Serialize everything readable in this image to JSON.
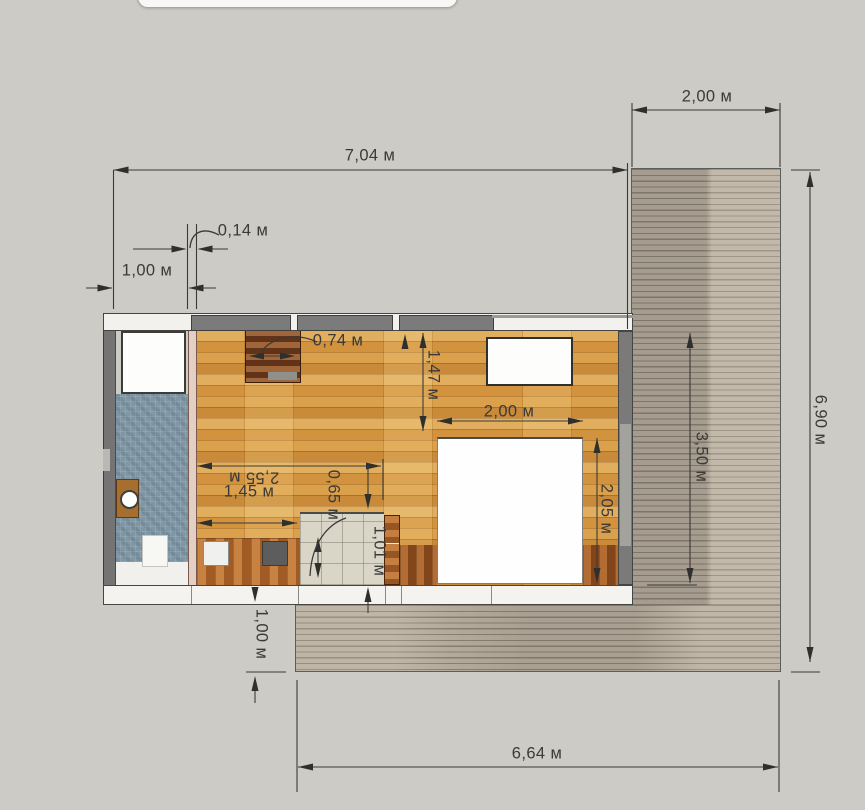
{
  "plan": {
    "unit": "м",
    "dimensions": [
      {
        "id": "total-width",
        "label": "7,04 м",
        "lx": 370,
        "ly": 156,
        "rot": 0,
        "lines": [
          [
            113.5,
            170,
            627.5,
            170
          ],
          [
            113.5,
            170,
            113.5,
            309
          ],
          [
            627.5,
            163,
            627.5,
            329
          ]
        ],
        "arrows": [
          [
            113.5,
            170,
            "left"
          ],
          [
            627.5,
            170,
            "right"
          ]
        ]
      },
      {
        "id": "deck-top-width",
        "label": "2,00 м",
        "lx": 707,
        "ly": 97,
        "rot": 0,
        "lines": [
          [
            632,
            110,
            780,
            110
          ],
          [
            632,
            103,
            632,
            167
          ],
          [
            780,
            103,
            780,
            167
          ]
        ],
        "arrows": [
          [
            632,
            110,
            "left"
          ],
          [
            780,
            110,
            "right"
          ]
        ]
      },
      {
        "id": "side-offset",
        "label": "1,00 м",
        "lx": 147,
        "ly": 271,
        "rot": 0,
        "lines": [
          [
            86,
            288,
            112,
            288
          ],
          [
            189,
            288,
            216,
            288
          ]
        ],
        "arrows": [
          [
            112.5,
            288,
            "right"
          ],
          [
            188.5,
            288,
            "left"
          ]
        ]
      },
      {
        "id": "wall-thickness",
        "label": "0,14 м",
        "lx": 243,
        "ly": 231,
        "rot": 0,
        "lines": [
          [
            133,
            249,
            185,
            249
          ],
          [
            199,
            249,
            228,
            249
          ],
          [
            187.5,
            224,
            187.5,
            309
          ],
          [
            196.5,
            224,
            196.5,
            309
          ]
        ],
        "arrows": [
          [
            186.5,
            249,
            "right"
          ],
          [
            197.5,
            249,
            "left"
          ]
        ],
        "path": "M 219 235 C 202 226 191 233 190 248"
      },
      {
        "id": "wardrobe-width",
        "label": "0,74 м",
        "lx": 338,
        "ly": 341,
        "rot": 0,
        "lines": [
          [
            252,
            356,
            292,
            356
          ]
        ],
        "arrows": [
          [
            249,
            356,
            "left"
          ],
          [
            295,
            356,
            "right"
          ]
        ],
        "path": "M 317 342 C 296 332 272 337 261 352"
      },
      {
        "id": "room-depth",
        "label": "1,47 м",
        "lx": 433,
        "ly": 375,
        "rot": 90,
        "lines": [
          [
            423,
            333,
            423,
            431
          ]
        ],
        "arrows": [
          [
            423,
            333,
            "up"
          ],
          [
            423,
            431,
            "down"
          ]
        ]
      },
      {
        "id": "bed-width",
        "label": "2,00 м",
        "lx": 509,
        "ly": 412,
        "rot": 0,
        "lines": [
          [
            437,
            421,
            583,
            421
          ]
        ],
        "arrows": [
          [
            437,
            421,
            "left"
          ],
          [
            583,
            421,
            "right"
          ]
        ]
      },
      {
        "id": "bed-length",
        "label": "2,05 м",
        "lx": 606,
        "ly": 509,
        "rot": 90,
        "lines": [
          [
            597,
            438,
            597,
            583
          ]
        ],
        "arrows": [
          [
            597,
            438,
            "up"
          ],
          [
            597,
            583,
            "down"
          ]
        ]
      },
      {
        "id": "kitchen-span",
        "label": "2,55 м",
        "lx": 254,
        "ly": 477,
        "rot": 180,
        "lines": [
          [
            197,
            466,
            381,
            466
          ],
          [
            383,
            459,
            383,
            500
          ]
        ],
        "arrows": [
          [
            197,
            466,
            "left"
          ],
          [
            381,
            466,
            "right"
          ]
        ]
      },
      {
        "id": "counter-gap",
        "label": "0,65 м",
        "lx": 333,
        "ly": 495,
        "rot": 90,
        "lines": [
          [
            368,
            466,
            368,
            494
          ]
        ],
        "arrows": [
          [
            368,
            509,
            "down"
          ]
        ]
      },
      {
        "id": "counter-width",
        "label": "1,45 м",
        "lx": 249,
        "ly": 492,
        "rot": 0,
        "lines": [
          [
            197,
            523,
            297,
            523
          ]
        ],
        "arrows": [
          [
            197,
            523,
            "left"
          ],
          [
            297,
            523,
            "right"
          ]
        ]
      },
      {
        "id": "entry-depth",
        "label": "1,01 м",
        "lx": 379,
        "ly": 551,
        "rot": 90,
        "lines": [
          [
            368,
            602,
            368,
            613
          ]
        ],
        "arrows": [
          [
            368,
            587,
            "up"
          ]
        ]
      },
      {
        "id": "deck-span",
        "label": "3,50 м",
        "lx": 701,
        "ly": 457,
        "rot": 90,
        "lines": [
          [
            690,
            333,
            690,
            583
          ],
          [
            647,
            585,
            697,
            585
          ]
        ],
        "arrows": [
          [
            690,
            333,
            "up"
          ],
          [
            690,
            583,
            "down"
          ]
        ]
      },
      {
        "id": "deck-height",
        "label": "6,90 м",
        "lx": 820,
        "ly": 420,
        "rot": 90,
        "lines": [
          [
            810,
            172,
            810,
            662
          ],
          [
            791,
            170,
            820,
            170
          ],
          [
            791,
            672,
            820,
            672
          ]
        ],
        "arrows": [
          [
            810,
            172,
            "up"
          ],
          [
            810,
            662,
            "down"
          ]
        ]
      },
      {
        "id": "deck-bottom-width",
        "label": "6,64 м",
        "lx": 537,
        "ly": 754,
        "rot": 0,
        "lines": [
          [
            298,
            767,
            778,
            767
          ],
          [
            297,
            680,
            297,
            792
          ],
          [
            779,
            680,
            779,
            792
          ]
        ],
        "arrows": [
          [
            298,
            767,
            "left"
          ],
          [
            778,
            767,
            "right"
          ]
        ]
      },
      {
        "id": "deck-offset",
        "label": "1,00 м",
        "lx": 261,
        "ly": 634,
        "rot": 90,
        "lines": [
          [
            255,
            691,
            255,
            703
          ],
          [
            246,
            672,
            286,
            672
          ]
        ],
        "arrows": [
          [
            255,
            602,
            "down"
          ],
          [
            255,
            676,
            "up"
          ]
        ]
      }
    ],
    "guides": [
      {
        "type": "line",
        "pts": [
          318,
          540,
          318,
          575
        ]
      },
      {
        "type": "arrow",
        "x": 318,
        "y": 537,
        "dir": "up"
      },
      {
        "type": "arrow",
        "x": 318,
        "y": 578,
        "dir": "down"
      },
      {
        "type": "arrow",
        "x": 405,
        "y": 334,
        "dir": "up"
      },
      {
        "type": "path",
        "d": "M 346 518 C 334 522 312 536 310 576"
      }
    ]
  },
  "colors": {
    "background": "#cccbc5",
    "dimension_text": "#3a3a38",
    "deck": "#b4aa9c",
    "parquet": "#d69944",
    "bath_tile": "#7f96a4",
    "entry_tile": "#d9d6c8",
    "wall_gray": "#7a7a7a",
    "wood_dark": "#7c4423"
  }
}
